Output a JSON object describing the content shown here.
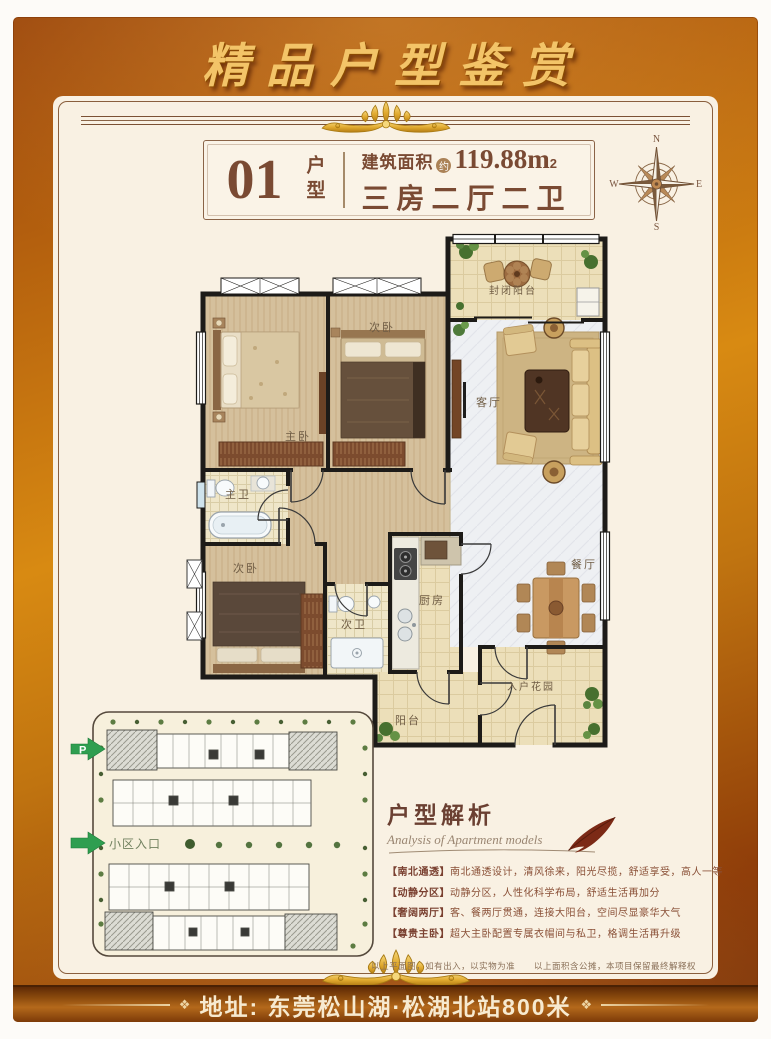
{
  "banner": {
    "title": "精品户型鉴赏"
  },
  "header": {
    "unit_number": "01",
    "unit_label": "户型",
    "area_label": "建筑面积",
    "area_approx": "约",
    "area_value": "119.88m",
    "area_sup": "2",
    "layout_text": "三房二厅二卫"
  },
  "compass": {
    "north": "N",
    "south": "S",
    "east": "E",
    "west": "W"
  },
  "floor_plan": {
    "rooms": [
      {
        "name": "封闭阳台"
      },
      {
        "name": "客厅"
      },
      {
        "name": "餐厅"
      },
      {
        "name": "主卧"
      },
      {
        "name": "次卧"
      },
      {
        "name": "主卫"
      },
      {
        "name": "次卧"
      },
      {
        "name": "次卫"
      },
      {
        "name": "厨房"
      },
      {
        "name": "阳台"
      },
      {
        "name": "入户花园"
      }
    ]
  },
  "site_plan": {
    "parking_label": "P",
    "entrance_label": "小区入口"
  },
  "analysis": {
    "title": "户型解析",
    "subtitle": "Analysis of Apartment models",
    "bullets": [
      {
        "tag": "【南北通透】",
        "text": "南北通透设计，清风徐来，阳光尽揽，舒适享受，高人一等"
      },
      {
        "tag": "【动静分区】",
        "text": "动静分区，人性化科学布局，舒适生活再加分"
      },
      {
        "tag": "【奢阔两厅】",
        "text": "客、餐两厅贯通，连接大阳台，空间尽显豪华大气"
      },
      {
        "tag": "【尊贵主卧】",
        "text": "超大主卧配置专属衣帽间与私卫，格调生活再升级"
      }
    ]
  },
  "footer": {
    "disclaimer_left": "以上平面图，如有出入，以实物为准",
    "disclaimer_right": "以上面积含公摊，本项目保留最终解释权",
    "address": "地址: 东莞松山湖·松湖北站800米"
  },
  "colors": {
    "frame_orange": "#c97a12",
    "panel_cream": "#f9f1e3",
    "title_gold": "#f3c468",
    "text_brown": "#7a4a33",
    "wall_black": "#1d1b18",
    "accent_green": "#2f9e50"
  }
}
